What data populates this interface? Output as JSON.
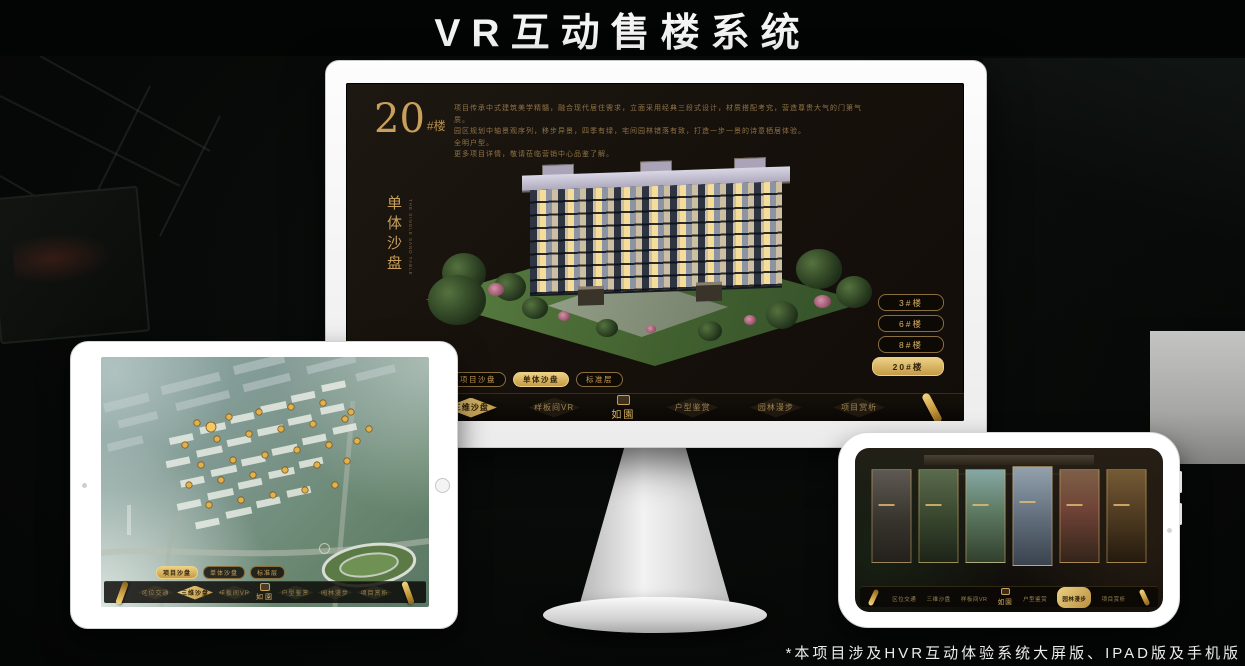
{
  "page": {
    "title": "VR互动售楼系统",
    "footnote": "*本项目涉及HVR互动体验系统大屏版、IPAD版及手机版"
  },
  "colors": {
    "gold": "#c9a05a",
    "gold_bright": "#ecd186",
    "screen_bg": "#17110c",
    "page_bg": "#070908"
  },
  "monitor": {
    "hero": {
      "number": "20",
      "unit": "#楼",
      "subtitle_vertical": "单体沙盘",
      "subtitle_en": "THE SINGLE SAND TABLE"
    },
    "description_lines": [
      "项目传承中式建筑美学精髓，融合现代居住需求，立面采用经典三段式设计，材质搭配考究，营造尊贵大气的门第气质。",
      "园区规划中轴景观序列，移步异景，四季有绿，宅间园林错落有致，打造一步一景的诗意栖居体验。",
      "全明户型。",
      "更多项目详情，敬请莅临营销中心品鉴了解。"
    ],
    "building_buttons": [
      {
        "label": "3#楼",
        "active": false
      },
      {
        "label": "6#楼",
        "active": false
      },
      {
        "label": "8#楼",
        "active": false
      },
      {
        "label": "20#楼",
        "active": true
      }
    ],
    "view_tabs": [
      {
        "label": "项目沙盘",
        "active": false
      },
      {
        "label": "单体沙盘",
        "active": true
      },
      {
        "label": "标准层",
        "active": false
      }
    ],
    "nav": {
      "logo": "如園",
      "items": [
        {
          "label": "区位交通",
          "active": false
        },
        {
          "label": "三维沙盘",
          "active": true
        },
        {
          "label": "样板间VR",
          "active": false
        },
        {
          "label": "户型鉴赏",
          "active": false
        },
        {
          "label": "园林漫步",
          "active": false
        },
        {
          "label": "项目赏析",
          "active": false
        }
      ]
    }
  },
  "tablet": {
    "view_tabs": [
      {
        "label": "项目沙盘",
        "active": true
      },
      {
        "label": "单体沙盘",
        "active": false
      },
      {
        "label": "标准层",
        "active": false
      }
    ],
    "nav": {
      "logo": "如園",
      "items": [
        {
          "label": "区位交通",
          "active": false
        },
        {
          "label": "三维沙盘",
          "active": true
        },
        {
          "label": "样板间VR",
          "active": false
        },
        {
          "label": "户型鉴赏",
          "active": false
        },
        {
          "label": "园林漫步",
          "active": false
        },
        {
          "label": "项目赏析",
          "active": false
        }
      ]
    }
  },
  "phone": {
    "nav": {
      "logo": "如園",
      "items": [
        {
          "label": "区位交通",
          "active": false
        },
        {
          "label": "三维沙盘",
          "active": false
        },
        {
          "label": "样板间VR",
          "active": false
        },
        {
          "label": "户型鉴赏",
          "active": false
        },
        {
          "label": "园林漫步",
          "active": true
        },
        {
          "label": "项目赏析",
          "active": false
        }
      ]
    }
  }
}
